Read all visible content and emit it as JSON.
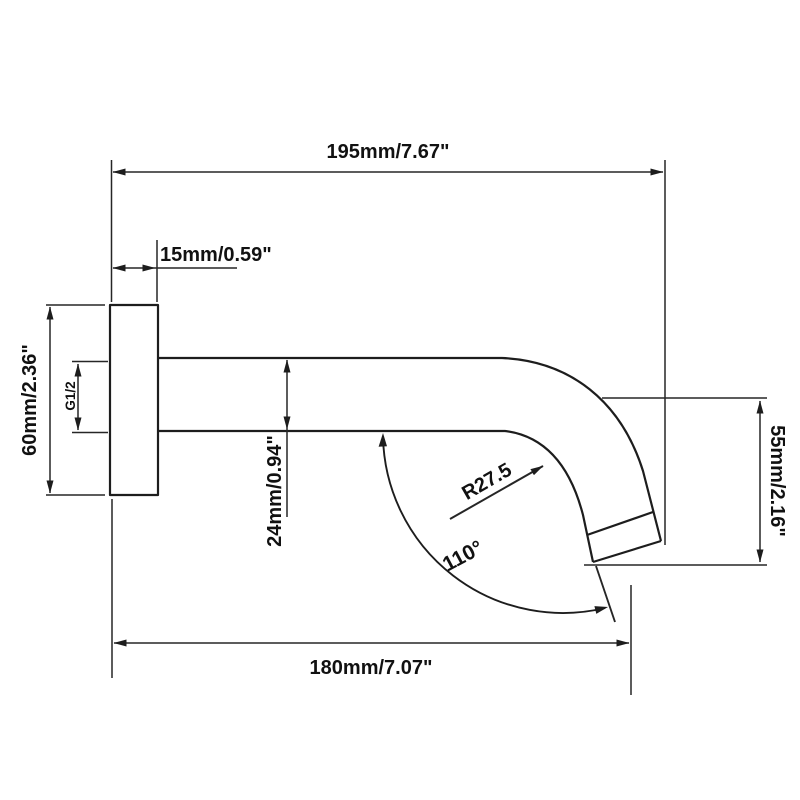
{
  "drawing": {
    "type": "technical-dimension-drawing",
    "subject": "wall-mounted shower arm side view",
    "background_color": "#ffffff",
    "line_color": "#1d1d1d",
    "labels": {
      "overall_length": "195mm/7.67\"",
      "flange_depth": "15mm/0.59\"",
      "flange_diameter": "60mm/2.36\"",
      "thread_size": "G1/2",
      "pipe_diameter": "24mm/0.94\"",
      "spout_drop": "55mm/2.16\"",
      "horizontal_reach": "180mm/7.07\"",
      "bend_radius": "R27.5",
      "spout_angle": "110°"
    }
  }
}
